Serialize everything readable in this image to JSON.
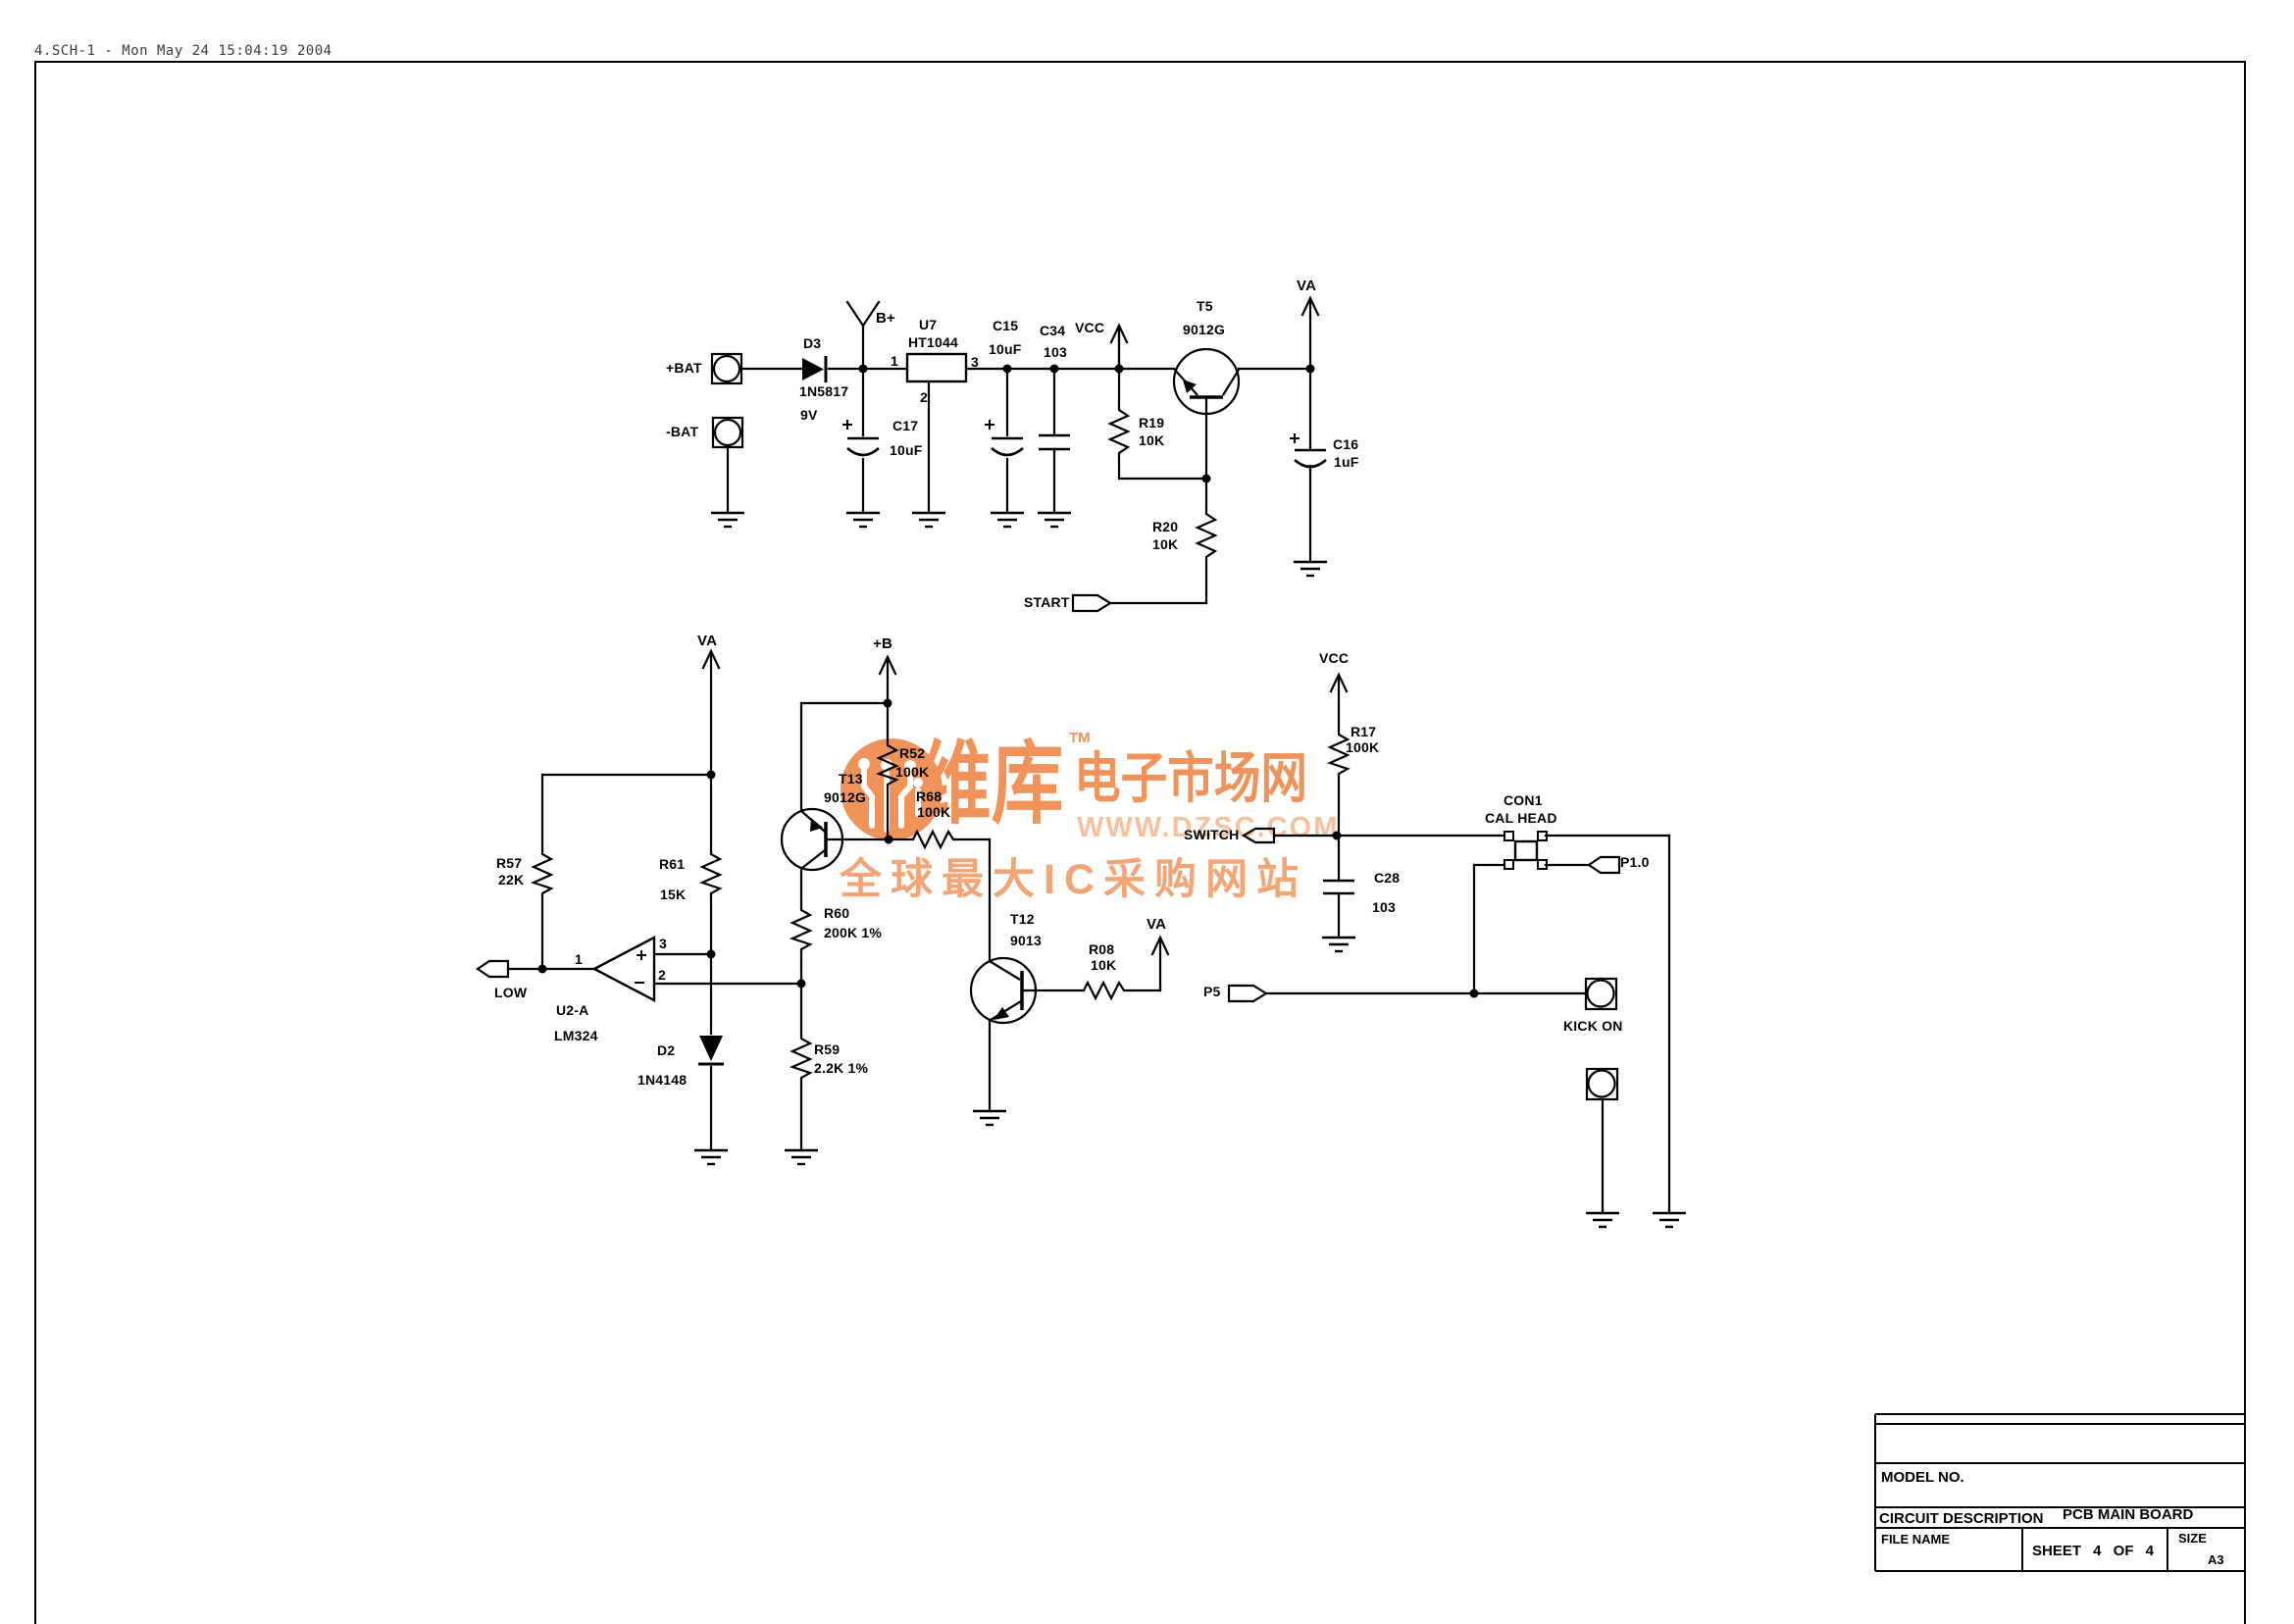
{
  "page": {
    "header_title": "4.SCH-1 - Mon May 24 15:04:19 2004"
  },
  "watermark": {
    "brand": "维库",
    "tm": "TM",
    "brand_suffix": "电子市场网",
    "url": "WWW.DZSC.COM",
    "tagline": "全球最大IC采购网站",
    "color_primary": "#F0935B",
    "color_light": "#F6C19C"
  },
  "title_block": {
    "model_no_label": "MODEL NO.",
    "circuit_description_label": "CIRCUIT DESCRIPTION",
    "circuit_description_value": "PCB MAIN BOARD",
    "file_name_label": "FILE NAME",
    "sheet_label": "SHEET 4 OF 4",
    "size_label": "SIZE",
    "size_value": "A3"
  },
  "labels": {
    "bat_pos": "+BAT",
    "bat_neg": "-BAT",
    "d3_ref": "D3",
    "d3_val": "1N5817",
    "d3_note": "9V",
    "b_plus": "B+",
    "u7_ref": "U7",
    "u7_val": "HT1044",
    "u7_pin1": "1",
    "u7_pin2": "2",
    "u7_pin3": "3",
    "c17_ref": "C17",
    "c17_val": "10uF",
    "c15_ref": "C15",
    "c15_val": "10uF",
    "c34_ref": "C34",
    "c34_val": "103",
    "vcc1": "VCC",
    "t5_ref": "T5",
    "t5_val": "9012G",
    "r19_ref": "R19",
    "r19_val": "10K",
    "va1": "VA",
    "c16_ref": "C16",
    "c16_val": "1uF",
    "r20_ref": "R20",
    "r20_val": "10K",
    "start": "START",
    "va2": "VA",
    "b_rail": "+B",
    "r57_ref": "R57",
    "r57_val": "22K",
    "r61_ref": "R61",
    "r61_val": "15K",
    "r52_ref": "R52",
    "r52_val": "100K",
    "t13_ref": "T13",
    "t13_val": "9012G",
    "r68_ref": "R68",
    "r68_val": "100K",
    "r60_ref": "R60",
    "r60_val": "200K 1%",
    "r59_ref": "R59",
    "r59_val": "2.2K 1%",
    "d2_ref": "D2",
    "d2_val": "1N4148",
    "op_pin1": "1",
    "op_pin2": "2",
    "op_pin3": "3",
    "u2a_ref": "U2-A",
    "u2a_val": "LM324",
    "low": "LOW",
    "t12_ref": "T12",
    "t12_val": "9013",
    "r08_ref": "R08",
    "r08_val": "10K",
    "va3": "VA",
    "p5": "P5",
    "kick_on": "KICK ON",
    "vcc2": "VCC",
    "r17_ref": "R17",
    "r17_val": "100K",
    "switch": "SWITCH",
    "c28_ref": "C28",
    "c28_val": "103",
    "con1_ref": "CON1",
    "con1_val": "CAL HEAD",
    "p1_0": "P1.0"
  }
}
